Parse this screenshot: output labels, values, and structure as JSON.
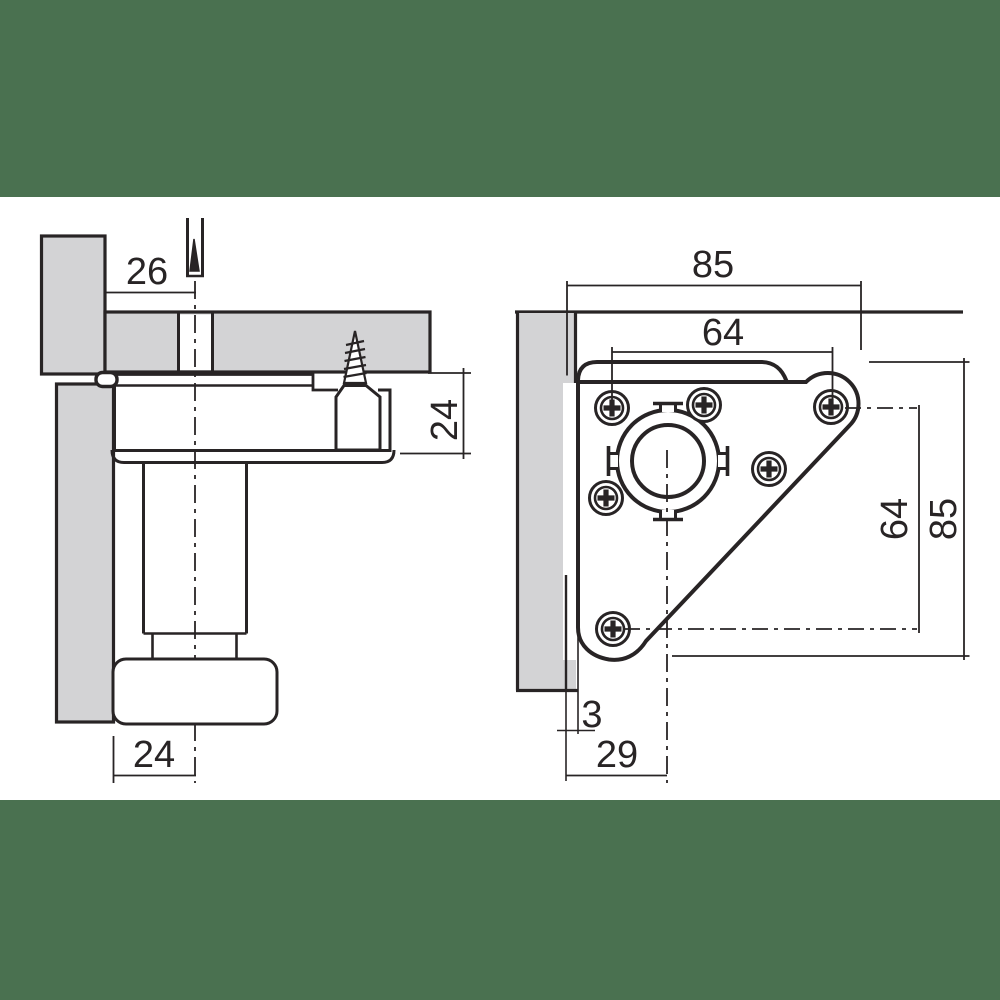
{
  "title": "furniture-leg-corner-mounting-plate-drawing",
  "colors": {
    "banner_green": "#4A7150",
    "paper_white": "#ffffff",
    "line_dark": "#282425",
    "panel_gray": "#d3d3d5"
  },
  "views": {
    "side_view": {
      "name": "side-section-view",
      "dimensions": {
        "hole_center_offset": "26",
        "plate_height": "24",
        "foot_half_width": "24"
      }
    },
    "top_view": {
      "name": "top-plan-view",
      "dimensions": {
        "plate_width": "85",
        "screw_spacing_horizontal": "64",
        "screw_spacing_vertical": "64",
        "plate_depth": "85",
        "edge_gap": "3",
        "center_offset": "29"
      }
    }
  }
}
